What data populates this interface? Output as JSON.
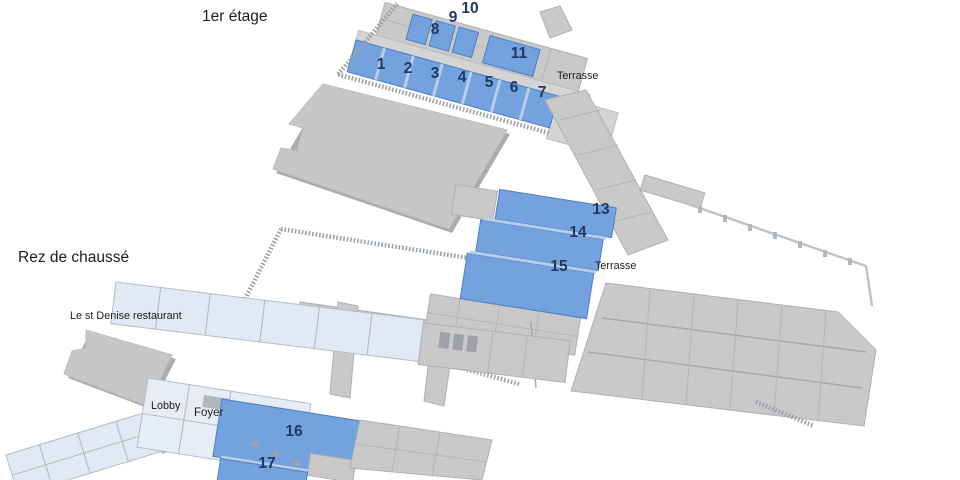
{
  "floors": {
    "first": {
      "title": "1er étage",
      "terrace_label": "Terrasse",
      "rooms": {
        "r1": "1",
        "r2": "2",
        "r3": "3",
        "r4": "4",
        "r5": "5",
        "r6": "6",
        "r7": "7",
        "r8": "8",
        "r9": "9",
        "r10": "10",
        "r11": "11"
      }
    },
    "ground": {
      "title": "Rez de chaussé",
      "terrace_label": "Terrasse",
      "restaurant_label": "Le st Denise restaurant",
      "lobby_label": "Lobby",
      "foyer_label": "Foyer",
      "rooms": {
        "r13": "13",
        "r14": "14",
        "r15": "15",
        "r16": "16",
        "r17": "17"
      }
    }
  },
  "legend": {
    "highlighted_room_color": "#74A2DE",
    "building_color": "#C9C9C9",
    "room_number_color": "#1F3864"
  }
}
